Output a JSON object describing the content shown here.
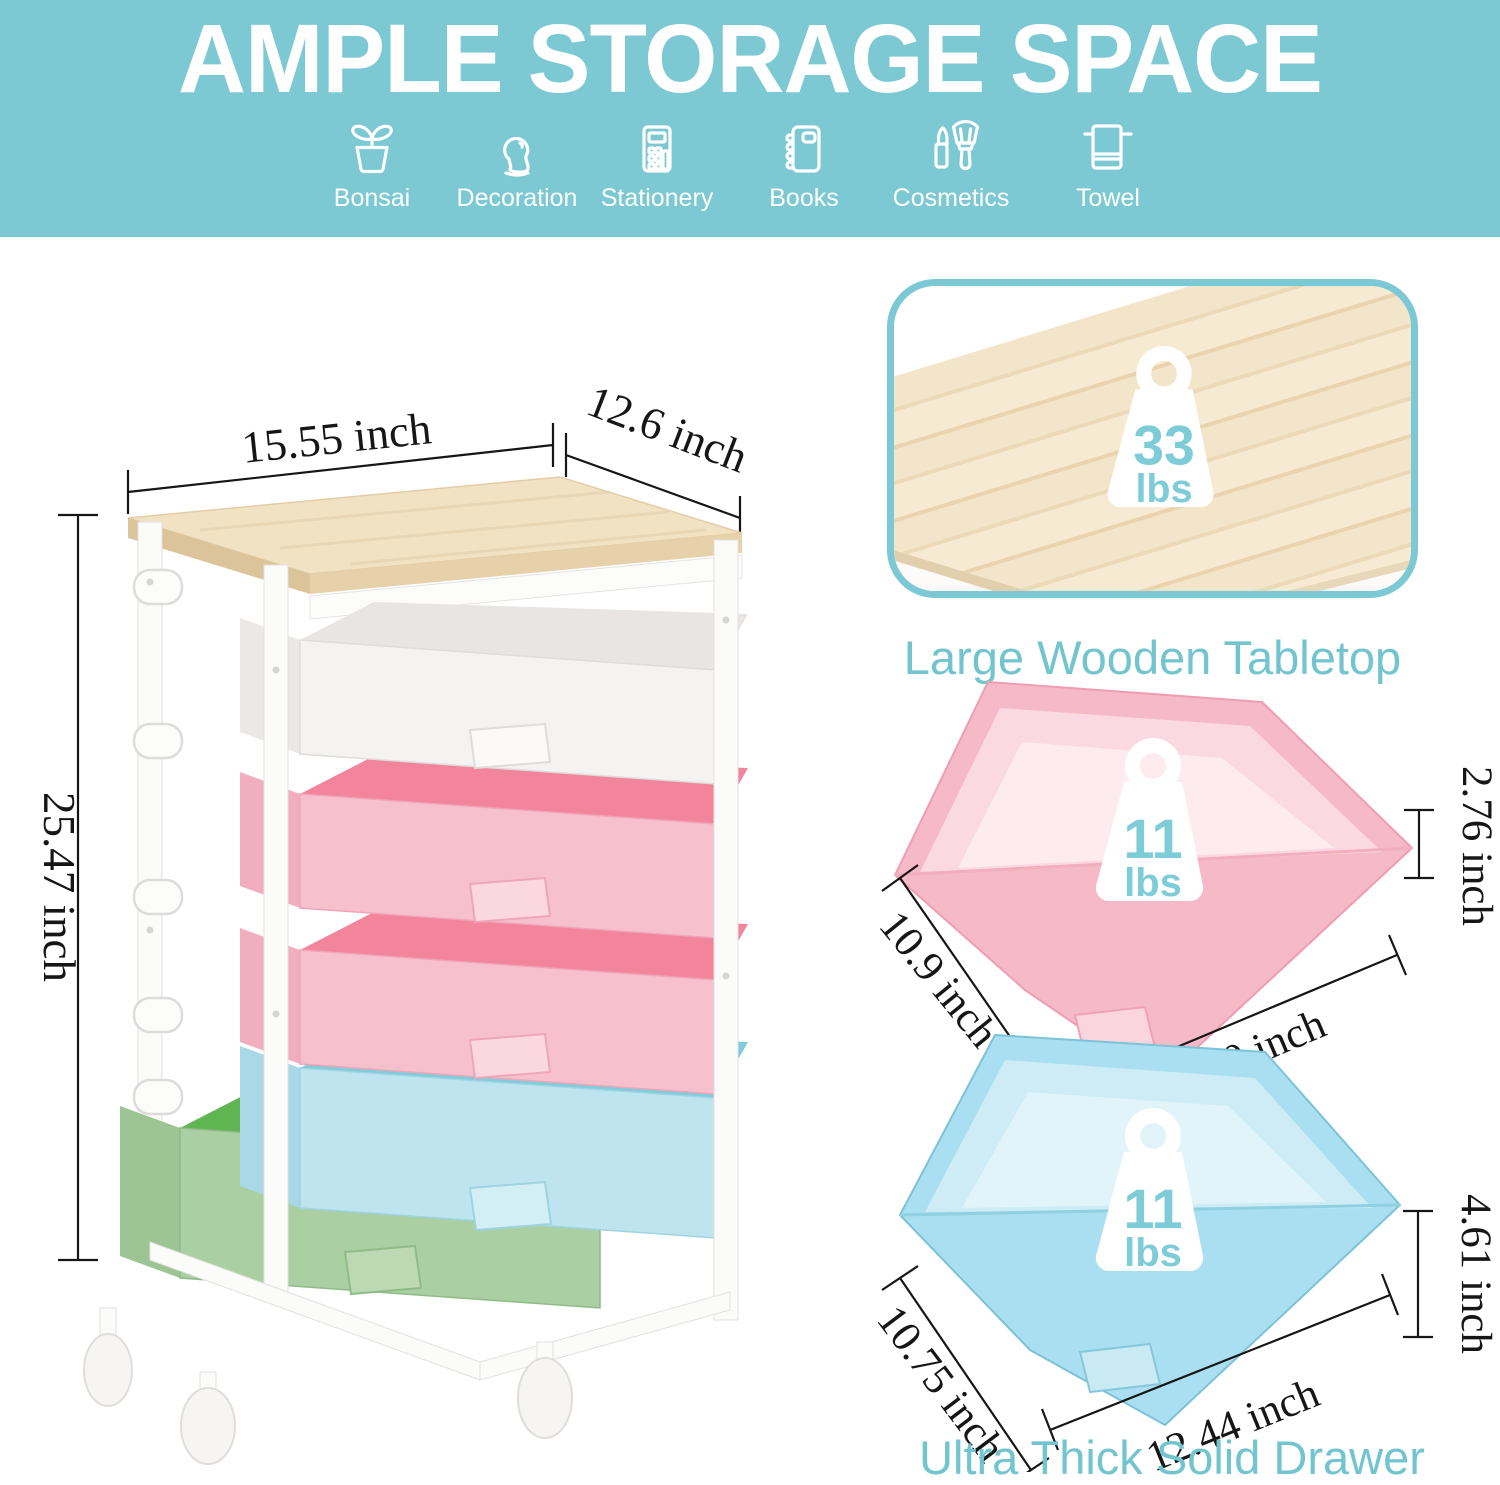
{
  "banner": {
    "title": "AMPLE STORAGE SPACE",
    "bg_color": "#7cc9d4",
    "text_color": "#ffffff",
    "categories": [
      {
        "label": "Bonsai",
        "icon": "bonsai-icon"
      },
      {
        "label": "Decoration",
        "icon": "decoration-icon"
      },
      {
        "label": "Stationery",
        "icon": "stationery-icon"
      },
      {
        "label": "Books",
        "icon": "books-icon"
      },
      {
        "label": "Cosmetics",
        "icon": "cosmetics-icon"
      },
      {
        "label": "Towel",
        "icon": "towel-icon"
      }
    ]
  },
  "cart_figure": {
    "width_label": "15.55 inch",
    "depth_label": "12.6 inch",
    "height_label": "25.47 inch",
    "tabletop_color": "#f2e2c4",
    "frame_color": "#fbfbfa",
    "drawers": [
      {
        "position": 1,
        "color_name": "white",
        "hex": "#f5f3f1"
      },
      {
        "position": 2,
        "color_name": "pink",
        "hex": "#f7c0cd"
      },
      {
        "position": 3,
        "color_name": "pink",
        "hex": "#f7c0cd"
      },
      {
        "position": 4,
        "color_name": "blue",
        "hex": "#bee5ef"
      },
      {
        "position": 5,
        "color_name": "green",
        "hex": "#aacfa2"
      }
    ]
  },
  "tabletop_card": {
    "caption": "Large Wooden Tabletop",
    "weight": {
      "value": "33",
      "unit": "lbs"
    },
    "border_color": "#7cc9d5",
    "caption_color": "#72c4cf"
  },
  "pink_drawer_figure": {
    "weight": {
      "value": "11",
      "unit": "lbs"
    },
    "depth_label": "10.9 inch",
    "width_label": "12.60 inch",
    "height_label": "2.76 inch",
    "color_hex": "#f6b9c8"
  },
  "blue_drawer_figure": {
    "caption": "Ultra Thick Solid Drawer",
    "weight": {
      "value": "11",
      "unit": "lbs"
    },
    "depth_label": "10.75 inch",
    "width_label": "12.44 inch",
    "height_label": "4.61 inch",
    "color_hex": "#a9dff0"
  }
}
